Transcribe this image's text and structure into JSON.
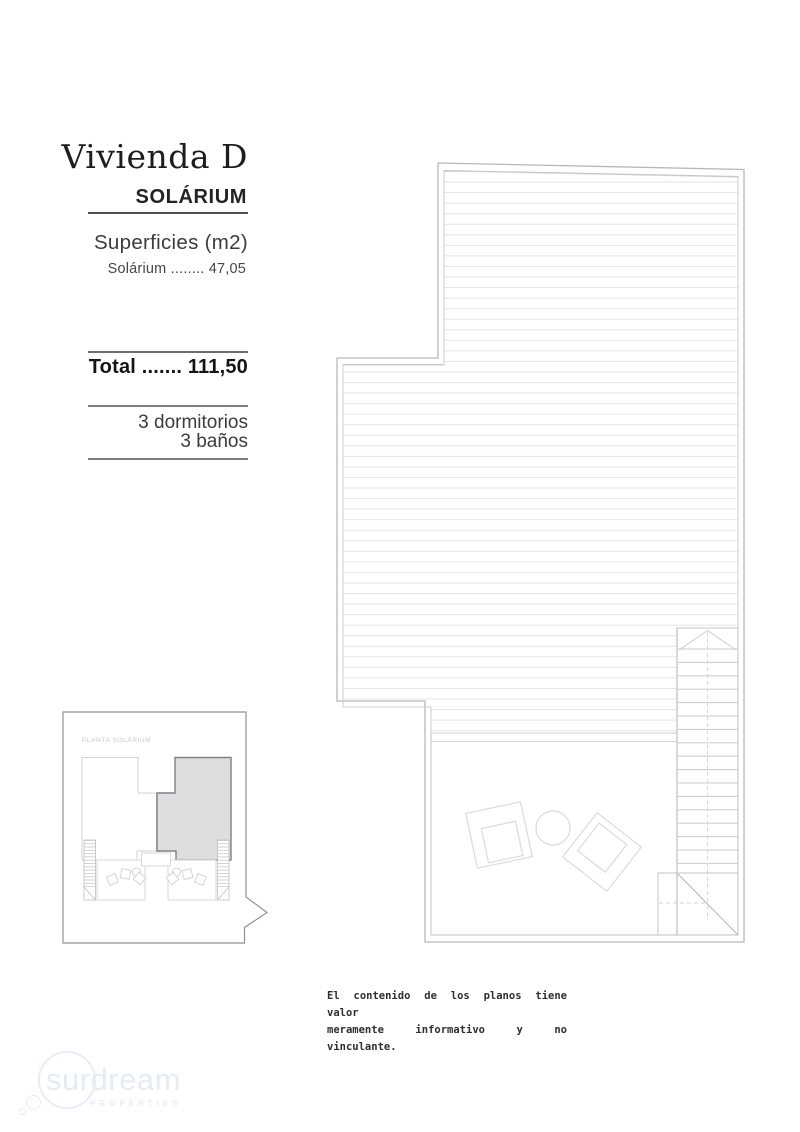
{
  "info_panel": {
    "title": "Vivienda D",
    "subtitle": "SOLÁRIUM",
    "surfaces_heading": "Superficies (m2)",
    "surface_line": "Solárium ........ 47,05",
    "total_line": "Total ....... 111,50",
    "features": [
      "3 dormitorios",
      "3 baños"
    ]
  },
  "inset": {
    "label": "PLANTA SOLÁRIUM"
  },
  "disclaimer": {
    "line1": "El contenido de los planos tiene valor",
    "line2": "meramente informativo y no vinculante."
  },
  "watermark": {
    "brand": "surdream",
    "tagline": "PROPERTIES",
    "color": "#e4ecf4"
  },
  "plan": {
    "wall_color": "#b5b8bb",
    "hatch_color": "#e3e4e5",
    "furniture_color": "#d9dbdd",
    "inset_highlight_fill": "#dcdee0",
    "inset_highlight_stroke": "#7e8185"
  }
}
